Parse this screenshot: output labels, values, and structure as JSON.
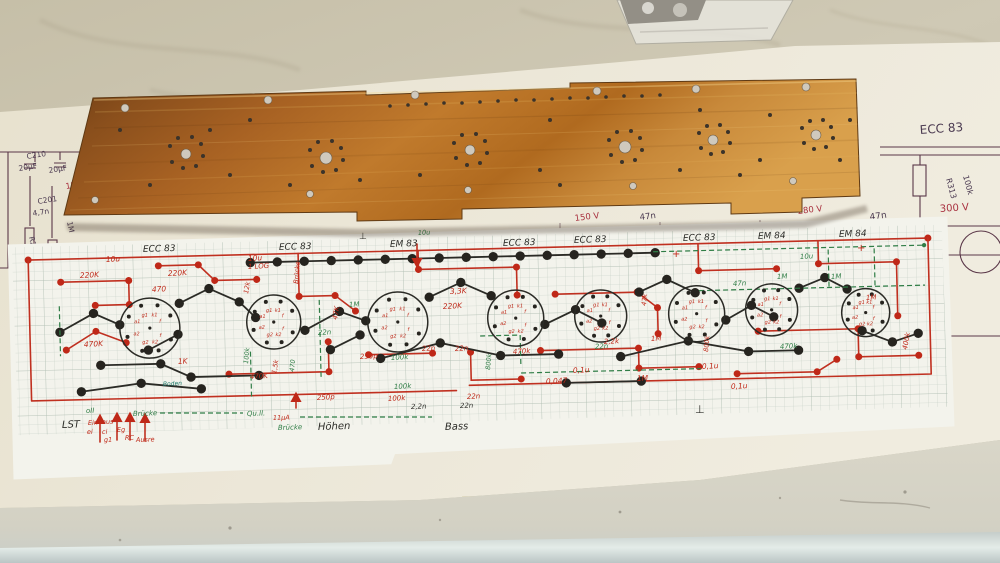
{
  "scene": {
    "description": "Copper PCB blank lying over a hand-drawn circuit layout on graph paper, on top of a printed tube-amplifier schematic, on a marble countertop"
  },
  "colors": {
    "red": "#bf2818",
    "green": "#2f7d46",
    "black": "#2c2c28",
    "teal": "#1d7a6a",
    "blue": "#3a56a0",
    "print_dark": "#4a3950",
    "print_red": "#a93240",
    "copper": "#b06a24",
    "marble": "#c9c2ac",
    "paper": "#ece7d8",
    "graph_paper": "#f3f3ec"
  },
  "printed_schematic": {
    "labels": [
      {
        "t": "C210",
        "x": 27,
        "y": 159,
        "c": "pd",
        "s": 7.5,
        "r": -9
      },
      {
        "t": "20μF",
        "x": 19,
        "y": 171,
        "c": "pd",
        "s": 7.5,
        "r": -9
      },
      {
        "t": "C220",
        "x": 79,
        "y": 161,
        "c": "pd",
        "s": 7.5,
        "r": -9
      },
      {
        "t": "20μF",
        "x": 49,
        "y": 173,
        "c": "pd",
        "s": 7.5,
        "r": -9
      },
      {
        "t": "150V",
        "x": 66,
        "y": 189,
        "c": "pr",
        "s": 8,
        "r": -9
      },
      {
        "t": "C201",
        "x": 38,
        "y": 204,
        "c": "pd",
        "s": 7.5,
        "r": -9
      },
      {
        "t": "4,7n",
        "x": 33,
        "y": 216,
        "c": "pd",
        "s": 7.5,
        "r": -9
      },
      {
        "t": "1M",
        "x": 67,
        "y": 222,
        "c": "pd",
        "s": 7.5,
        "r": 78
      },
      {
        "t": "R201",
        "x": 29,
        "y": 237,
        "c": "pd",
        "s": 7.5,
        "r": 78
      },
      {
        "t": "R202",
        "x": 56,
        "y": 246,
        "c": "pd",
        "s": 7.5,
        "r": 78
      },
      {
        "t": "1,25V",
        "x": 23,
        "y": 276,
        "c": "pr",
        "s": 8,
        "r": -9
      },
      {
        "t": "ECC 83",
        "x": 920,
        "y": 134,
        "c": "pd",
        "s": 12,
        "r": -4
      },
      {
        "t": "R313",
        "x": 946,
        "y": 179,
        "c": "pd",
        "s": 8,
        "r": 75
      },
      {
        "t": "100k",
        "x": 963,
        "y": 176,
        "c": "pd",
        "s": 8,
        "r": 75
      },
      {
        "t": "300 V",
        "x": 940,
        "y": 212,
        "c": "pr",
        "s": 10,
        "r": -4
      },
      {
        "t": "47n",
        "x": 870,
        "y": 220,
        "c": "pd",
        "s": 9,
        "r": -8
      },
      {
        "t": "R310",
        "x": 926,
        "y": 301,
        "c": "pd",
        "s": 8,
        "r": 78
      },
      {
        "t": "1M",
        "x": 941,
        "y": 301,
        "c": "pd",
        "s": 8,
        "r": 78
      },
      {
        "t": "150 V",
        "x": 575,
        "y": 221,
        "c": "pr",
        "s": 8.5,
        "r": -7
      },
      {
        "t": "47n",
        "x": 640,
        "y": 220,
        "c": "pd",
        "s": 8.5,
        "r": -7
      },
      {
        "t": "280 V",
        "x": 798,
        "y": 214,
        "c": "pr",
        "s": 8.5,
        "r": -7
      }
    ]
  },
  "hand_layout": {
    "labels": [
      {
        "t": "ECC 83",
        "x": 143,
        "y": 252,
        "c": "k",
        "s": 9,
        "r": -2
      },
      {
        "t": "ECC 83",
        "x": 279,
        "y": 250,
        "c": "k",
        "s": 9,
        "r": -2
      },
      {
        "t": "EM 83",
        "x": 390,
        "y": 247,
        "c": "k",
        "s": 9,
        "r": -2
      },
      {
        "t": "ECC 83",
        "x": 503,
        "y": 246,
        "c": "k",
        "s": 9,
        "r": -2
      },
      {
        "t": "ECC 83",
        "x": 574,
        "y": 243,
        "c": "k",
        "s": 9,
        "r": -2
      },
      {
        "t": "ECC 83",
        "x": 683,
        "y": 241,
        "c": "k",
        "s": 9,
        "r": -2
      },
      {
        "t": "EM 84",
        "x": 758,
        "y": 239,
        "c": "k",
        "s": 9,
        "r": -2
      },
      {
        "t": "EM 84",
        "x": 839,
        "y": 237,
        "c": "k",
        "s": 9,
        "r": -2
      },
      {
        "t": "LST",
        "x": 62,
        "y": 428,
        "c": "k",
        "s": 10,
        "r": -2
      },
      {
        "t": "Höhen",
        "x": 318,
        "y": 430,
        "c": "k",
        "s": 10,
        "r": -2
      },
      {
        "t": "Bass",
        "x": 445,
        "y": 430,
        "c": "k",
        "s": 10,
        "r": -2
      },
      {
        "t": "⊥",
        "x": 695,
        "y": 413,
        "c": "k",
        "s": 11,
        "r": 0
      },
      {
        "t": "⊥",
        "x": 359,
        "y": 239,
        "c": "k",
        "s": 9,
        "r": 0
      },
      {
        "t": "2,2n",
        "x": 411,
        "y": 409,
        "c": "k",
        "s": 7,
        "r": -2
      },
      {
        "t": "22n",
        "x": 460,
        "y": 408,
        "c": "k",
        "s": 7,
        "r": -2
      },
      {
        "t": "10u",
        "x": 106,
        "y": 262,
        "c": "r",
        "s": 7.5,
        "r": -3
      },
      {
        "t": "220K",
        "x": 80,
        "y": 278,
        "c": "r",
        "s": 7.5,
        "r": -3
      },
      {
        "t": "220K",
        "x": 168,
        "y": 276,
        "c": "r",
        "s": 7.5,
        "r": -3
      },
      {
        "t": "10u",
        "x": 248,
        "y": 261,
        "c": "r",
        "s": 7.5,
        "r": -3
      },
      {
        "t": "1 LOG",
        "x": 248,
        "y": 269,
        "c": "r",
        "s": 7,
        "r": -3
      },
      {
        "t": "Brücke",
        "x": 298,
        "y": 284,
        "c": "r",
        "s": 6.5,
        "r": -85
      },
      {
        "t": "12k",
        "x": 248,
        "y": 294,
        "c": "r",
        "s": 6.5,
        "r": -80
      },
      {
        "t": "470",
        "x": 152,
        "y": 292,
        "c": "r",
        "s": 7.5,
        "r": -3
      },
      {
        "t": "470K",
        "x": 84,
        "y": 347,
        "c": "r",
        "s": 7.5,
        "r": -3
      },
      {
        "t": "1K",
        "x": 178,
        "y": 364,
        "c": "r",
        "s": 7.5,
        "r": -3
      },
      {
        "t": "470K",
        "x": 250,
        "y": 379,
        "c": "r",
        "s": 7,
        "r": -3
      },
      {
        "t": "1,5k",
        "x": 276,
        "y": 374,
        "c": "r",
        "s": 6.5,
        "r": -80
      },
      {
        "t": "3,3K",
        "x": 450,
        "y": 294,
        "c": "r",
        "s": 7.5,
        "r": -3
      },
      {
        "t": "220K",
        "x": 443,
        "y": 309,
        "c": "r",
        "s": 7.5,
        "r": -3
      },
      {
        "t": "47K",
        "x": 337,
        "y": 320,
        "c": "r",
        "s": 7,
        "r": -80
      },
      {
        "t": "250p",
        "x": 360,
        "y": 359,
        "c": "r",
        "s": 7,
        "r": -3
      },
      {
        "t": "22n",
        "x": 422,
        "y": 351,
        "c": "r",
        "s": 7,
        "r": -3
      },
      {
        "t": "22n",
        "x": 455,
        "y": 351,
        "c": "r",
        "s": 7,
        "r": -3
      },
      {
        "t": "250p",
        "x": 317,
        "y": 400,
        "c": "r",
        "s": 7,
        "r": -3
      },
      {
        "t": "100k",
        "x": 388,
        "y": 401,
        "c": "r",
        "s": 7,
        "r": -3
      },
      {
        "t": "22n",
        "x": 467,
        "y": 399,
        "c": "r",
        "s": 7,
        "r": -3
      },
      {
        "t": "470k",
        "x": 513,
        "y": 354,
        "c": "r",
        "s": 7,
        "r": -3
      },
      {
        "t": "0,1u",
        "x": 573,
        "y": 373,
        "c": "r",
        "s": 7.5,
        "r": -3
      },
      {
        "t": "0,047",
        "x": 546,
        "y": 384,
        "c": "r",
        "s": 7.5,
        "r": -3
      },
      {
        "t": "1M",
        "x": 637,
        "y": 381,
        "c": "r",
        "s": 7.5,
        "r": -3
      },
      {
        "t": "2,2k",
        "x": 604,
        "y": 344,
        "c": "r",
        "s": 7,
        "r": -3
      },
      {
        "t": "1M",
        "x": 651,
        "y": 341,
        "c": "r",
        "s": 7,
        "r": -3
      },
      {
        "t": "800k",
        "x": 708,
        "y": 352,
        "c": "r",
        "s": 6.5,
        "r": -85
      },
      {
        "t": "0,1u",
        "x": 702,
        "y": 369,
        "c": "r",
        "s": 7.5,
        "r": -3
      },
      {
        "t": "0,1u",
        "x": 731,
        "y": 389,
        "c": "r",
        "s": 7.5,
        "r": -3
      },
      {
        "t": "47k",
        "x": 646,
        "y": 306,
        "c": "r",
        "s": 6.5,
        "r": -85
      },
      {
        "t": "400k",
        "x": 907,
        "y": 350,
        "c": "r",
        "s": 7,
        "r": -80
      },
      {
        "t": "1M",
        "x": 866,
        "y": 300,
        "c": "r",
        "s": 7,
        "r": -3
      },
      {
        "t": "Ein",
        "x": 88,
        "y": 425,
        "c": "r",
        "s": 6.5,
        "r": -2
      },
      {
        "t": "ei",
        "x": 87,
        "y": 434,
        "c": "r",
        "s": 6.5,
        "r": -2
      },
      {
        "t": "aus",
        "x": 102,
        "y": 424,
        "c": "r",
        "s": 6.5,
        "r": -2
      },
      {
        "t": "ci",
        "x": 102,
        "y": 434,
        "c": "r",
        "s": 6.5,
        "r": -2
      },
      {
        "t": "g1",
        "x": 104,
        "y": 442,
        "c": "r",
        "s": 6.5,
        "r": -2
      },
      {
        "t": "Eg",
        "x": 117,
        "y": 432,
        "c": "r",
        "s": 6.5,
        "r": -2
      },
      {
        "t": "RC",
        "x": 125,
        "y": 440,
        "c": "r",
        "s": 6.5,
        "r": -2
      },
      {
        "t": "Ausre",
        "x": 136,
        "y": 442,
        "c": "r",
        "s": 6.5,
        "r": -2
      },
      {
        "t": "11μA",
        "x": 273,
        "y": 420,
        "c": "r",
        "s": 6.5,
        "r": -2
      },
      {
        "t": "+",
        "x": 672,
        "y": 257,
        "c": "r",
        "s": 10,
        "r": 0
      },
      {
        "t": "+",
        "x": 857,
        "y": 251,
        "c": "r",
        "s": 10,
        "r": 0
      },
      {
        "t": "oII",
        "x": 86,
        "y": 413,
        "c": "g",
        "s": 7,
        "r": -2
      },
      {
        "t": "Brücke",
        "x": 133,
        "y": 416,
        "c": "g",
        "s": 7,
        "r": -2
      },
      {
        "t": "Qu.ll.",
        "x": 247,
        "y": 416,
        "c": "g",
        "s": 7,
        "r": -2
      },
      {
        "t": "Brücke",
        "x": 278,
        "y": 430,
        "c": "g",
        "s": 7,
        "r": -2
      },
      {
        "t": "100k",
        "x": 248,
        "y": 364,
        "c": "g",
        "s": 6.5,
        "r": -85
      },
      {
        "t": "470",
        "x": 294,
        "y": 372,
        "c": "g",
        "s": 6.5,
        "r": -85
      },
      {
        "t": "1M",
        "x": 349,
        "y": 307,
        "c": "g",
        "s": 7,
        "r": -3
      },
      {
        "t": "22n",
        "x": 318,
        "y": 335,
        "c": "g",
        "s": 7,
        "r": -3
      },
      {
        "t": "100k",
        "x": 391,
        "y": 360,
        "c": "g",
        "s": 7,
        "r": -3
      },
      {
        "t": "100k",
        "x": 394,
        "y": 389,
        "c": "g",
        "s": 7,
        "r": -3
      },
      {
        "t": "800k",
        "x": 490,
        "y": 370,
        "c": "g",
        "s": 6.5,
        "r": -85
      },
      {
        "t": "22n",
        "x": 595,
        "y": 349,
        "c": "g",
        "s": 7,
        "r": -3
      },
      {
        "t": "470k",
        "x": 780,
        "y": 349,
        "c": "g",
        "s": 7,
        "r": -3
      },
      {
        "t": "1M",
        "x": 777,
        "y": 279,
        "c": "g",
        "s": 7,
        "r": -3
      },
      {
        "t": "1M",
        "x": 831,
        "y": 279,
        "c": "g",
        "s": 7,
        "r": -3
      },
      {
        "t": "47n",
        "x": 733,
        "y": 286,
        "c": "g",
        "s": 7,
        "r": -3
      },
      {
        "t": "10u",
        "x": 800,
        "y": 259,
        "c": "g",
        "s": 7,
        "r": -3
      },
      {
        "t": "10u",
        "x": 418,
        "y": 235,
        "c": "g",
        "s": 6.5,
        "r": -3
      },
      {
        "t": "Boden",
        "x": 163,
        "y": 386,
        "c": "t",
        "s": 6,
        "r": -3
      }
    ],
    "pin_labels": [
      "a1",
      "g1",
      "k1",
      "f",
      "f",
      "k2",
      "g2",
      "a2"
    ],
    "sockets": [
      {
        "cx": 150,
        "cy": 320,
        "r": 30
      },
      {
        "cx": 274,
        "cy": 317,
        "r": 27
      },
      {
        "cx": 398,
        "cy": 320,
        "r": 30
      },
      {
        "cx": 516,
        "cy": 319,
        "r": 28
      },
      {
        "cx": 601,
        "cy": 319,
        "r": 26
      },
      {
        "cx": 697,
        "cy": 319,
        "r": 28
      },
      {
        "cx": 772,
        "cy": 317,
        "r": 26
      },
      {
        "cx": 866,
        "cy": 322,
        "r": 24
      }
    ],
    "red_arrows": [
      {
        "x": 100,
        "y1": 442,
        "y2": 416
      },
      {
        "x": 117,
        "y1": 440,
        "y2": 414
      },
      {
        "x": 130,
        "y1": 440,
        "y2": 414
      },
      {
        "x": 145,
        "y1": 441,
        "y2": 415
      },
      {
        "x": 296,
        "y1": 408,
        "y2": 394
      },
      {
        "x": 417,
        "y1": 244,
        "y2": 266
      },
      {
        "x": 503,
        "y1": 537,
        "y2": 515
      }
    ]
  },
  "copper_board": {
    "holes_light": [
      [
        125,
        108,
        4
      ],
      [
        268,
        100,
        4
      ],
      [
        415,
        95,
        4
      ],
      [
        597,
        91,
        4
      ],
      [
        696,
        89,
        4
      ],
      [
        806,
        87,
        4
      ],
      [
        95,
        200,
        3.5
      ],
      [
        310,
        194,
        3.5
      ],
      [
        468,
        190,
        3.5
      ],
      [
        633,
        186,
        3.5
      ],
      [
        793,
        181,
        3.5
      ],
      [
        326,
        158,
        6
      ],
      [
        625,
        147,
        6
      ],
      [
        186,
        154,
        5
      ],
      [
        470,
        150,
        5
      ],
      [
        713,
        140,
        5
      ],
      [
        816,
        135,
        5
      ]
    ],
    "holes_dark": [
      [
        170,
        146,
        2
      ],
      [
        178,
        138,
        2
      ],
      [
        192,
        137,
        2
      ],
      [
        201,
        144,
        2
      ],
      [
        203,
        156,
        2
      ],
      [
        196,
        166,
        2
      ],
      [
        183,
        168,
        2
      ],
      [
        172,
        162,
        2
      ],
      [
        310,
        150,
        2
      ],
      [
        318,
        142,
        2
      ],
      [
        332,
        141,
        2
      ],
      [
        341,
        148,
        2
      ],
      [
        343,
        160,
        2
      ],
      [
        336,
        170,
        2
      ],
      [
        323,
        172,
        2
      ],
      [
        312,
        166,
        2
      ],
      [
        454,
        143,
        2
      ],
      [
        462,
        135,
        2
      ],
      [
        476,
        134,
        2
      ],
      [
        485,
        141,
        2
      ],
      [
        487,
        153,
        2
      ],
      [
        480,
        163,
        2
      ],
      [
        467,
        165,
        2
      ],
      [
        456,
        158,
        2
      ],
      [
        609,
        140,
        2
      ],
      [
        617,
        132,
        2
      ],
      [
        631,
        131,
        2
      ],
      [
        640,
        138,
        2
      ],
      [
        642,
        150,
        2
      ],
      [
        635,
        160,
        2
      ],
      [
        622,
        162,
        2
      ],
      [
        611,
        155,
        2
      ],
      [
        699,
        133,
        2
      ],
      [
        707,
        126,
        2
      ],
      [
        720,
        125,
        2
      ],
      [
        728,
        132,
        2
      ],
      [
        730,
        143,
        2
      ],
      [
        723,
        152,
        2
      ],
      [
        711,
        154,
        2
      ],
      [
        701,
        148,
        2
      ],
      [
        802,
        128,
        2
      ],
      [
        810,
        121,
        2
      ],
      [
        823,
        120,
        2
      ],
      [
        831,
        127,
        2
      ],
      [
        833,
        138,
        2
      ],
      [
        826,
        147,
        2
      ],
      [
        814,
        149,
        2
      ],
      [
        804,
        143,
        2
      ],
      [
        390,
        106,
        1.8
      ],
      [
        408,
        105,
        1.8
      ],
      [
        426,
        104,
        1.8
      ],
      [
        444,
        103,
        1.8
      ],
      [
        462,
        103,
        1.8
      ],
      [
        480,
        102,
        1.8
      ],
      [
        498,
        101,
        1.8
      ],
      [
        516,
        100,
        1.8
      ],
      [
        534,
        100,
        1.8
      ],
      [
        552,
        99,
        1.8
      ],
      [
        570,
        98,
        1.8
      ],
      [
        588,
        98,
        1.8
      ],
      [
        606,
        97,
        1.8
      ],
      [
        624,
        96,
        1.8
      ],
      [
        642,
        96,
        1.8
      ],
      [
        660,
        95,
        1.8
      ],
      [
        150,
        185,
        2
      ],
      [
        230,
        175,
        2
      ],
      [
        250,
        120,
        2
      ],
      [
        290,
        185,
        2
      ],
      [
        360,
        180,
        2
      ],
      [
        420,
        175,
        2
      ],
      [
        540,
        170,
        2
      ],
      [
        560,
        185,
        2
      ],
      [
        680,
        170,
        2
      ],
      [
        740,
        175,
        2
      ],
      [
        760,
        160,
        2
      ],
      [
        840,
        160,
        2
      ],
      [
        850,
        120,
        2
      ],
      [
        120,
        130,
        2
      ],
      [
        210,
        130,
        2
      ],
      [
        550,
        120,
        2
      ],
      [
        700,
        110,
        2
      ],
      [
        770,
        115,
        2
      ]
    ]
  }
}
